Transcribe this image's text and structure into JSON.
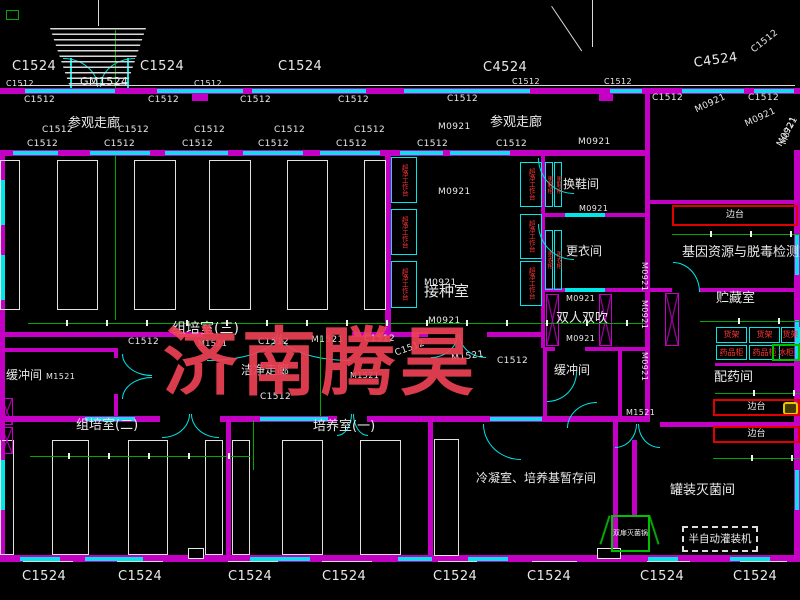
{
  "title": "组培实验室平面图 (tissue culture lab floor plan, CAD)",
  "watermark": {
    "text": "济南腾昊",
    "color": "#ee4254"
  },
  "colors": {
    "background": "#000000",
    "wall_magenta": "#c400c4",
    "window_cyan": "#00e7e7",
    "dimension_green": "#00a800",
    "text_white": "#e9e9e9",
    "equipment_red": "#e00000",
    "equipment_text_red": "#ff3434",
    "watermark_red": "#ee4254"
  },
  "room_labels": [
    {
      "text": "参观走廊",
      "x": 68,
      "y": 117,
      "size": 13
    },
    {
      "text": "参观走廊",
      "x": 490,
      "y": 116,
      "size": 13
    },
    {
      "text": "换鞋间",
      "x": 563,
      "y": 178,
      "size": 12
    },
    {
      "text": "更衣间",
      "x": 566,
      "y": 245,
      "size": 12
    },
    {
      "text": "接种室",
      "x": 424,
      "y": 284,
      "size": 15
    },
    {
      "text": "双人双吹",
      "x": 556,
      "y": 312,
      "size": 13
    },
    {
      "text": "缓冲间",
      "x": 6,
      "y": 369,
      "size": 12
    },
    {
      "text": "缓冲间",
      "x": 554,
      "y": 364,
      "size": 12
    },
    {
      "text": "组培室(三)",
      "x": 172,
      "y": 322,
      "size": 14
    },
    {
      "text": "洁净走廊",
      "x": 241,
      "y": 364,
      "size": 12
    },
    {
      "text": "组培室(二)",
      "x": 76,
      "y": 419,
      "size": 13
    },
    {
      "text": "培养室(一)",
      "x": 313,
      "y": 420,
      "size": 13
    },
    {
      "text": "基因资源与脱毒检测室",
      "x": 682,
      "y": 246,
      "size": 13
    },
    {
      "text": "贮藏室",
      "x": 716,
      "y": 292,
      "size": 13
    },
    {
      "text": "配药间",
      "x": 714,
      "y": 371,
      "size": 13
    },
    {
      "text": "罐装灭菌间",
      "x": 670,
      "y": 484,
      "size": 13
    },
    {
      "text": "冷凝室、培养基暂存间",
      "x": 476,
      "y": 472,
      "size": 12
    }
  ],
  "door_window_codes": [
    {
      "text": "C1524",
      "x": 12,
      "y": 60,
      "size": 13
    },
    {
      "text": "C1524",
      "x": 140,
      "y": 60,
      "size": 13
    },
    {
      "text": "C1524",
      "x": 278,
      "y": 60,
      "size": 13
    },
    {
      "text": "C4524",
      "x": 483,
      "y": 61,
      "size": 13
    },
    {
      "text": "C4524",
      "x": 693,
      "y": 57,
      "size": 13,
      "rot": -8
    },
    {
      "text": "C1512",
      "x": 750,
      "y": 48,
      "size": 9,
      "rot": -38
    },
    {
      "text": "GM1524",
      "x": 80,
      "y": 76,
      "size": 11
    },
    {
      "text": "C1512",
      "x": 6,
      "y": 80,
      "size": 8
    },
    {
      "text": "C1512",
      "x": 194,
      "y": 80,
      "size": 8
    },
    {
      "text": "C1512",
      "x": 512,
      "y": 78,
      "size": 8
    },
    {
      "text": "C1512",
      "x": 604,
      "y": 78,
      "size": 8
    },
    {
      "text": "C1512",
      "x": 24,
      "y": 96,
      "size": 9
    },
    {
      "text": "C1512",
      "x": 148,
      "y": 96,
      "size": 9
    },
    {
      "text": "C1512",
      "x": 240,
      "y": 96,
      "size": 9
    },
    {
      "text": "C1512",
      "x": 338,
      "y": 96,
      "size": 9
    },
    {
      "text": "C1512",
      "x": 447,
      "y": 95,
      "size": 9
    },
    {
      "text": "C1512",
      "x": 652,
      "y": 94,
      "size": 9
    },
    {
      "text": "C1512",
      "x": 748,
      "y": 94,
      "size": 9
    },
    {
      "text": "C1512",
      "x": 42,
      "y": 126,
      "size": 9
    },
    {
      "text": "C1512",
      "x": 118,
      "y": 126,
      "size": 9
    },
    {
      "text": "C1512",
      "x": 194,
      "y": 126,
      "size": 9
    },
    {
      "text": "C1512",
      "x": 274,
      "y": 126,
      "size": 9
    },
    {
      "text": "C1512",
      "x": 354,
      "y": 126,
      "size": 9
    },
    {
      "text": "M0921",
      "x": 438,
      "y": 123,
      "size": 9
    },
    {
      "text": "M0921",
      "x": 694,
      "y": 107,
      "size": 9,
      "rot": -25
    },
    {
      "text": "M0921",
      "x": 744,
      "y": 121,
      "size": 9,
      "rot": -25
    },
    {
      "text": "M0921",
      "x": 776,
      "y": 144,
      "size": 9,
      "rot": -60
    },
    {
      "text": "C1512",
      "x": 27,
      "y": 140,
      "size": 9
    },
    {
      "text": "C1512",
      "x": 104,
      "y": 140,
      "size": 9
    },
    {
      "text": "C1512",
      "x": 182,
      "y": 140,
      "size": 9
    },
    {
      "text": "C1512",
      "x": 258,
      "y": 140,
      "size": 9
    },
    {
      "text": "C1512",
      "x": 336,
      "y": 140,
      "size": 9
    },
    {
      "text": "C1512",
      "x": 417,
      "y": 140,
      "size": 9
    },
    {
      "text": "C1512",
      "x": 496,
      "y": 140,
      "size": 9
    },
    {
      "text": "M0921",
      "x": 578,
      "y": 138,
      "size": 9
    },
    {
      "text": "M0921",
      "x": 438,
      "y": 188,
      "size": 9
    },
    {
      "text": "M0921",
      "x": 424,
      "y": 279,
      "size": 9
    },
    {
      "text": "M0921",
      "x": 428,
      "y": 317,
      "size": 9
    },
    {
      "text": "M0921",
      "x": 579,
      "y": 205,
      "size": 8
    },
    {
      "text": "M0921",
      "x": 566,
      "y": 295,
      "size": 8
    },
    {
      "text": "M0921",
      "x": 566,
      "y": 335,
      "size": 8
    },
    {
      "text": "M0921",
      "x": 648,
      "y": 262,
      "size": 8,
      "rot": 90
    },
    {
      "text": "M0921",
      "x": 648,
      "y": 300,
      "size": 8,
      "rot": 90
    },
    {
      "text": "M0921",
      "x": 648,
      "y": 352,
      "size": 8,
      "rot": 90
    },
    {
      "text": "M0721",
      "x": 780,
      "y": 143,
      "size": 8,
      "rot": -70
    },
    {
      "text": "C1512",
      "x": 128,
      "y": 338,
      "size": 9
    },
    {
      "text": "M1521",
      "x": 198,
      "y": 340,
      "size": 8
    },
    {
      "text": "C1512",
      "x": 258,
      "y": 338,
      "size": 9
    },
    {
      "text": "M1521",
      "x": 311,
      "y": 336,
      "size": 9
    },
    {
      "text": "C1512",
      "x": 364,
      "y": 335,
      "size": 9
    },
    {
      "text": "C1512",
      "x": 394,
      "y": 350,
      "size": 9,
      "rot": -20
    },
    {
      "text": "M1521",
      "x": 451,
      "y": 355,
      "size": 9,
      "rot": -8
    },
    {
      "text": "C1512",
      "x": 497,
      "y": 357,
      "size": 9
    },
    {
      "text": "M1521",
      "x": 46,
      "y": 373,
      "size": 8
    },
    {
      "text": "M1521",
      "x": 350,
      "y": 372,
      "size": 8
    },
    {
      "text": "C1512",
      "x": 260,
      "y": 393,
      "size": 9
    },
    {
      "text": "M1521",
      "x": 626,
      "y": 409,
      "size": 8
    },
    {
      "text": "C1524",
      "x": 22,
      "y": 570,
      "size": 13
    },
    {
      "text": "C1524",
      "x": 118,
      "y": 570,
      "size": 13
    },
    {
      "text": "C1524",
      "x": 228,
      "y": 570,
      "size": 13
    },
    {
      "text": "C1524",
      "x": 322,
      "y": 570,
      "size": 13
    },
    {
      "text": "C1524",
      "x": 433,
      "y": 570,
      "size": 13
    },
    {
      "text": "C1524",
      "x": 527,
      "y": 570,
      "size": 13
    },
    {
      "text": "C1524",
      "x": 640,
      "y": 570,
      "size": 13
    },
    {
      "text": "C1524",
      "x": 733,
      "y": 570,
      "size": 13
    }
  ],
  "equipment": [
    {
      "type": "red-bench",
      "label": "边台",
      "x": 672,
      "y": 205,
      "w": 126,
      "h": 21
    },
    {
      "type": "red-bench",
      "label": "边台",
      "x": 713,
      "y": 399,
      "w": 87,
      "h": 17
    },
    {
      "type": "red-bench",
      "label": "边台",
      "x": 713,
      "y": 426,
      "w": 87,
      "h": 17
    },
    {
      "type": "shelf",
      "label": "货架",
      "x": 716,
      "y": 327,
      "w": 31,
      "h": 16
    },
    {
      "type": "shelf",
      "label": "货架",
      "x": 749,
      "y": 327,
      "w": 31,
      "h": 16
    },
    {
      "type": "shelf",
      "label": "货架",
      "x": 781,
      "y": 327,
      "w": 19,
      "h": 16
    },
    {
      "type": "shelf",
      "label": "药品柜",
      "x": 716,
      "y": 345,
      "w": 31,
      "h": 15
    },
    {
      "type": "shelf",
      "label": "药品柜",
      "x": 749,
      "y": 345,
      "w": 31,
      "h": 15
    },
    {
      "type": "fridge",
      "label": "冰柜",
      "x": 772,
      "y": 344,
      "w": 28,
      "h": 17
    },
    {
      "type": "clean-bench",
      "label": "超净工作台",
      "x": 391,
      "y": 157,
      "w": 26,
      "h": 46
    },
    {
      "type": "clean-bench",
      "label": "超净工作台",
      "x": 391,
      "y": 209,
      "w": 26,
      "h": 46
    },
    {
      "type": "clean-bench",
      "label": "超净工作台",
      "x": 391,
      "y": 261,
      "w": 26,
      "h": 47
    },
    {
      "type": "clean-bench",
      "label": "超净工作台",
      "x": 520,
      "y": 162,
      "w": 22,
      "h": 45
    },
    {
      "type": "clean-bench",
      "label": "超净工作台",
      "x": 520,
      "y": 214,
      "w": 22,
      "h": 45
    },
    {
      "type": "clean-bench",
      "label": "超净工作台",
      "x": 520,
      "y": 261,
      "w": 22,
      "h": 45
    },
    {
      "type": "wardrobe",
      "label": "更鞋柜",
      "x": 545,
      "y": 162,
      "w": 8,
      "h": 45
    },
    {
      "type": "wardrobe",
      "label": "更鞋柜",
      "x": 554,
      "y": 162,
      "w": 8,
      "h": 45
    },
    {
      "type": "wardrobe",
      "label": "更衣柜",
      "x": 545,
      "y": 230,
      "w": 8,
      "h": 60
    },
    {
      "type": "wardrobe",
      "label": "更衣柜",
      "x": 554,
      "y": 230,
      "w": 8,
      "h": 60
    },
    {
      "type": "filler",
      "label": "半自动灌装机",
      "x": 682,
      "y": 526,
      "w": 76,
      "h": 26
    },
    {
      "type": "sterilizer",
      "label": "双扉灭菌锅",
      "x": 611,
      "y": 515,
      "w": 39,
      "h": 37
    }
  ]
}
